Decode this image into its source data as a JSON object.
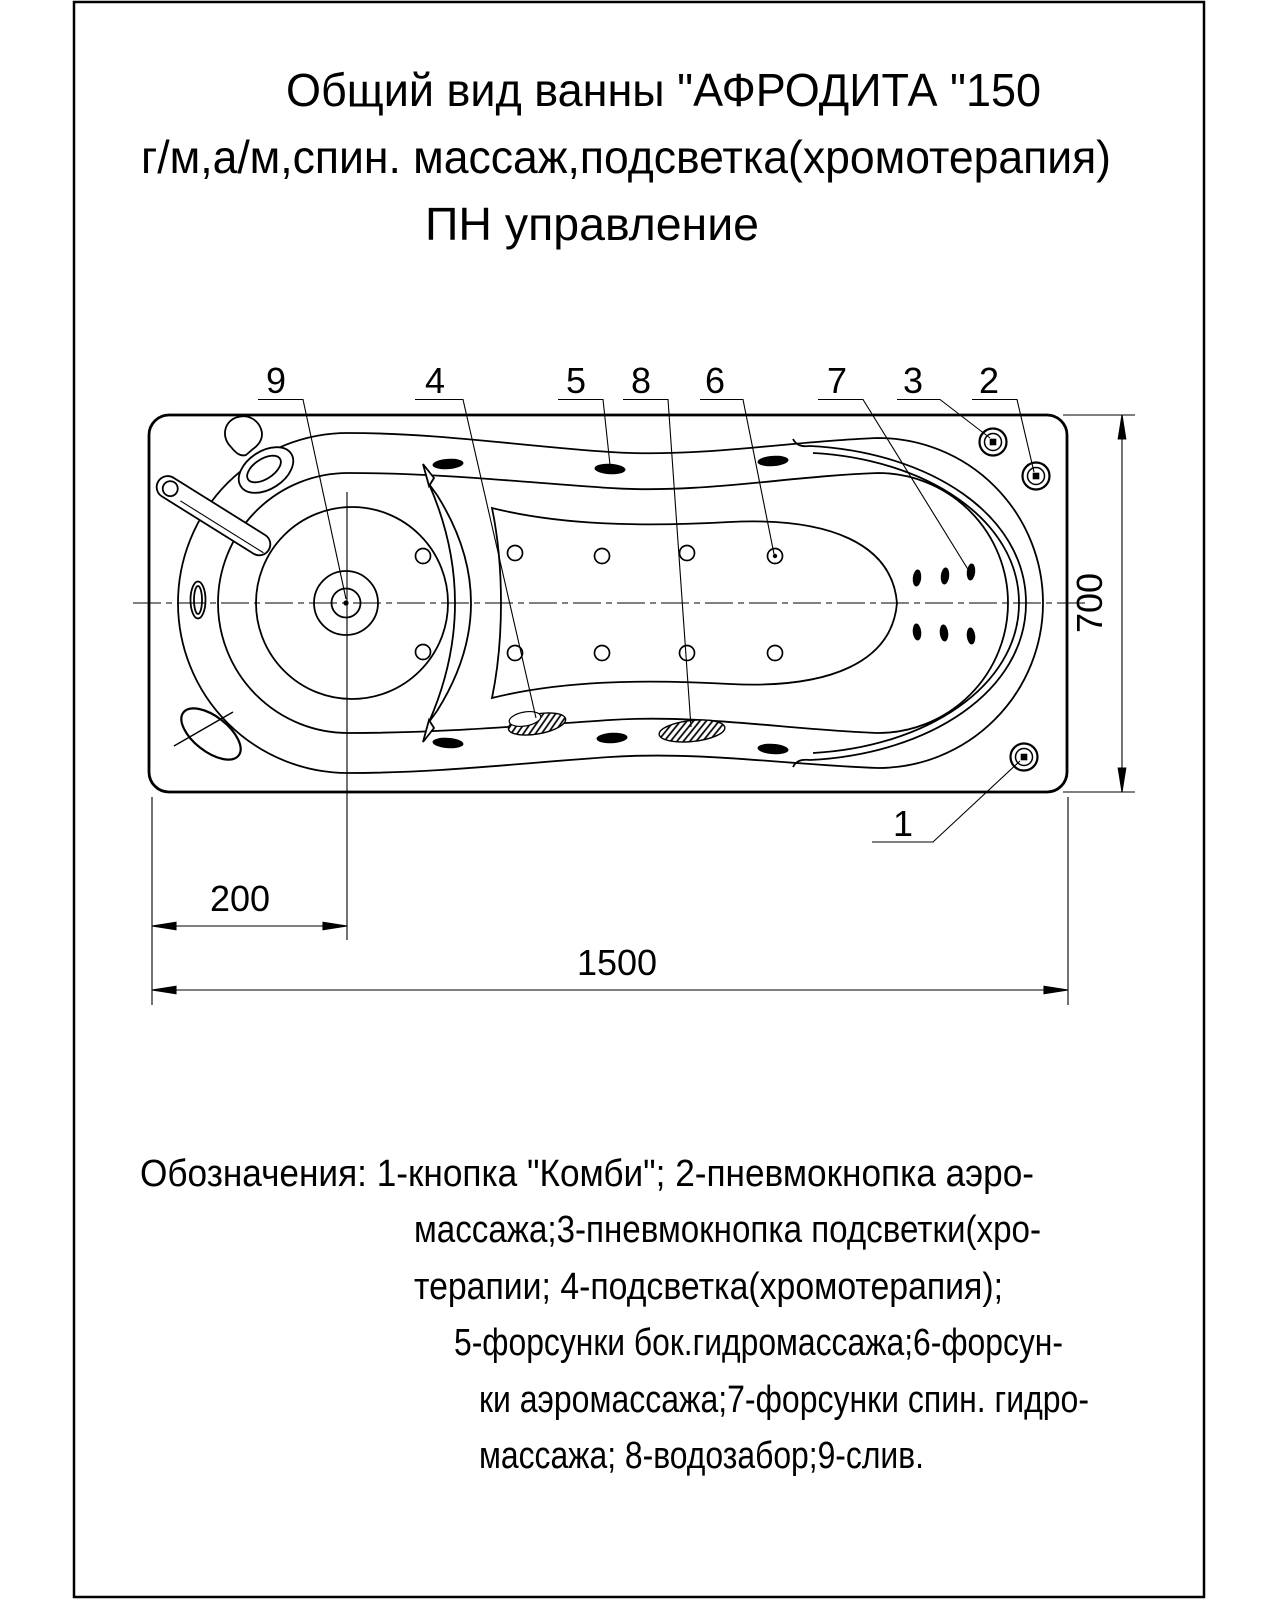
{
  "page": {
    "title_lines": [
      "Общий вид ванны \"АФРОДИТА \"150",
      "г/м,а/м,спин. массаж,подсветка(хромотерапия)",
      "ПН управление"
    ]
  },
  "drawing": {
    "callout_labels": [
      "9",
      "4",
      "5",
      "8",
      "6",
      "7",
      "3",
      "2",
      "1"
    ],
    "dimensions": {
      "width_mm": "700",
      "drain_offset_mm": "200",
      "length_mm": "1500"
    }
  },
  "legend": {
    "lines": [
      "Обозначения: 1-кнопка \"Комби\"; 2-пневмокнопка аэро-",
      "массажа;3-пневмокнопка подсветки(хро-",
      "терапии; 4-подсветка(хромотерапия);",
      "5-форсунки бок.гидромассажа;6-форсун-",
      "ки аэромассажа;7-форсунки спин. гидро-",
      "массажа; 8-водозабор;9-слив."
    ]
  },
  "colors": {
    "ink": "#000000",
    "paper": "#ffffff"
  }
}
